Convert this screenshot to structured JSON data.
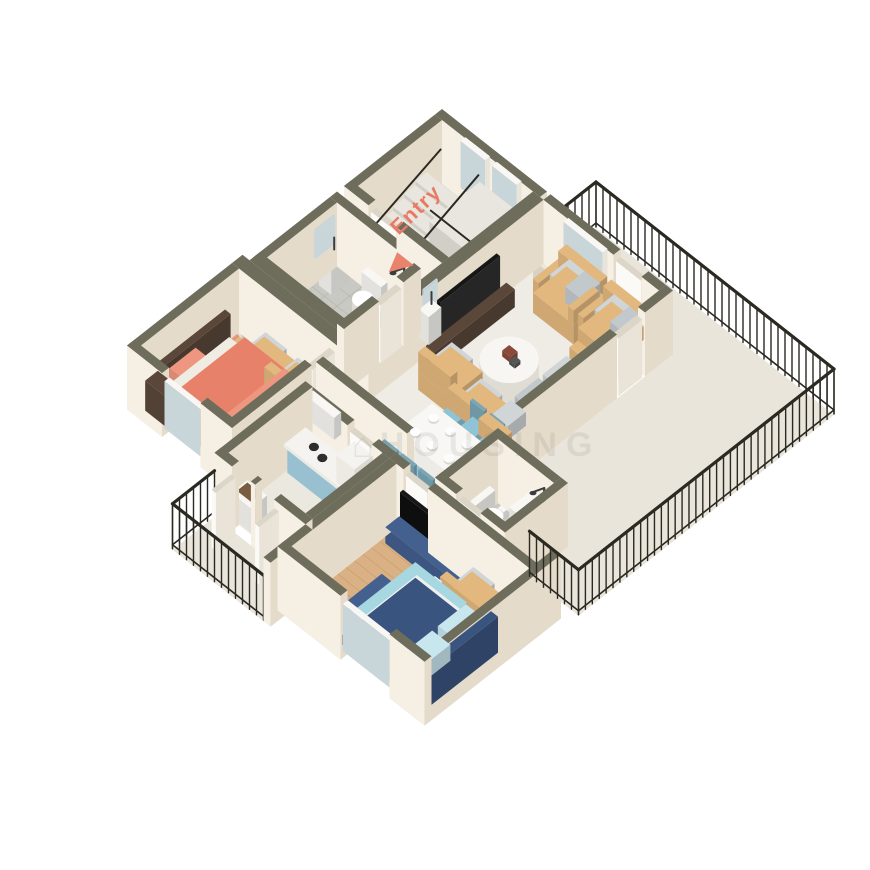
{
  "scene_labels": {
    "entry": "Entry",
    "watermark": "HOUSING"
  },
  "palette": {
    "background": "#ffffff",
    "wall_top": "#6e6d5c",
    "wall_light": "#f5efe4",
    "wall_shade": "#e5dbca",
    "floor_marble": "#efece5",
    "floor_marble_dim": "#e9e5db",
    "floor_wood": "#d9b184",
    "wood_line": "#c1945f",
    "floor_tile": "#c9c9c3",
    "tile_line": "#b7b7b1",
    "railing": "#2a2922",
    "stair": "#e9e6df",
    "sofa_tan": "#e2b87e",
    "cushion_gray": "#d0d5d8",
    "bed_coral": "#e8816a",
    "bed_coral_light": "#ee9680",
    "bed_blue": "#a7d7e1",
    "pillow_blue": "#c8e6ee",
    "navy": "#44608f",
    "navy_dark": "#3a5480",
    "chair_blue": "#8fc3d6",
    "cabinet_blue": "#a8d3e6",
    "wood_dark": "#5a473a",
    "tv_black": "#171717",
    "white": "#f8f7f3",
    "glass": "#c9d6d9",
    "door_white": "#fbfaf7",
    "accent": "#e87a63",
    "fixture_dark": "#3c3c3c"
  }
}
